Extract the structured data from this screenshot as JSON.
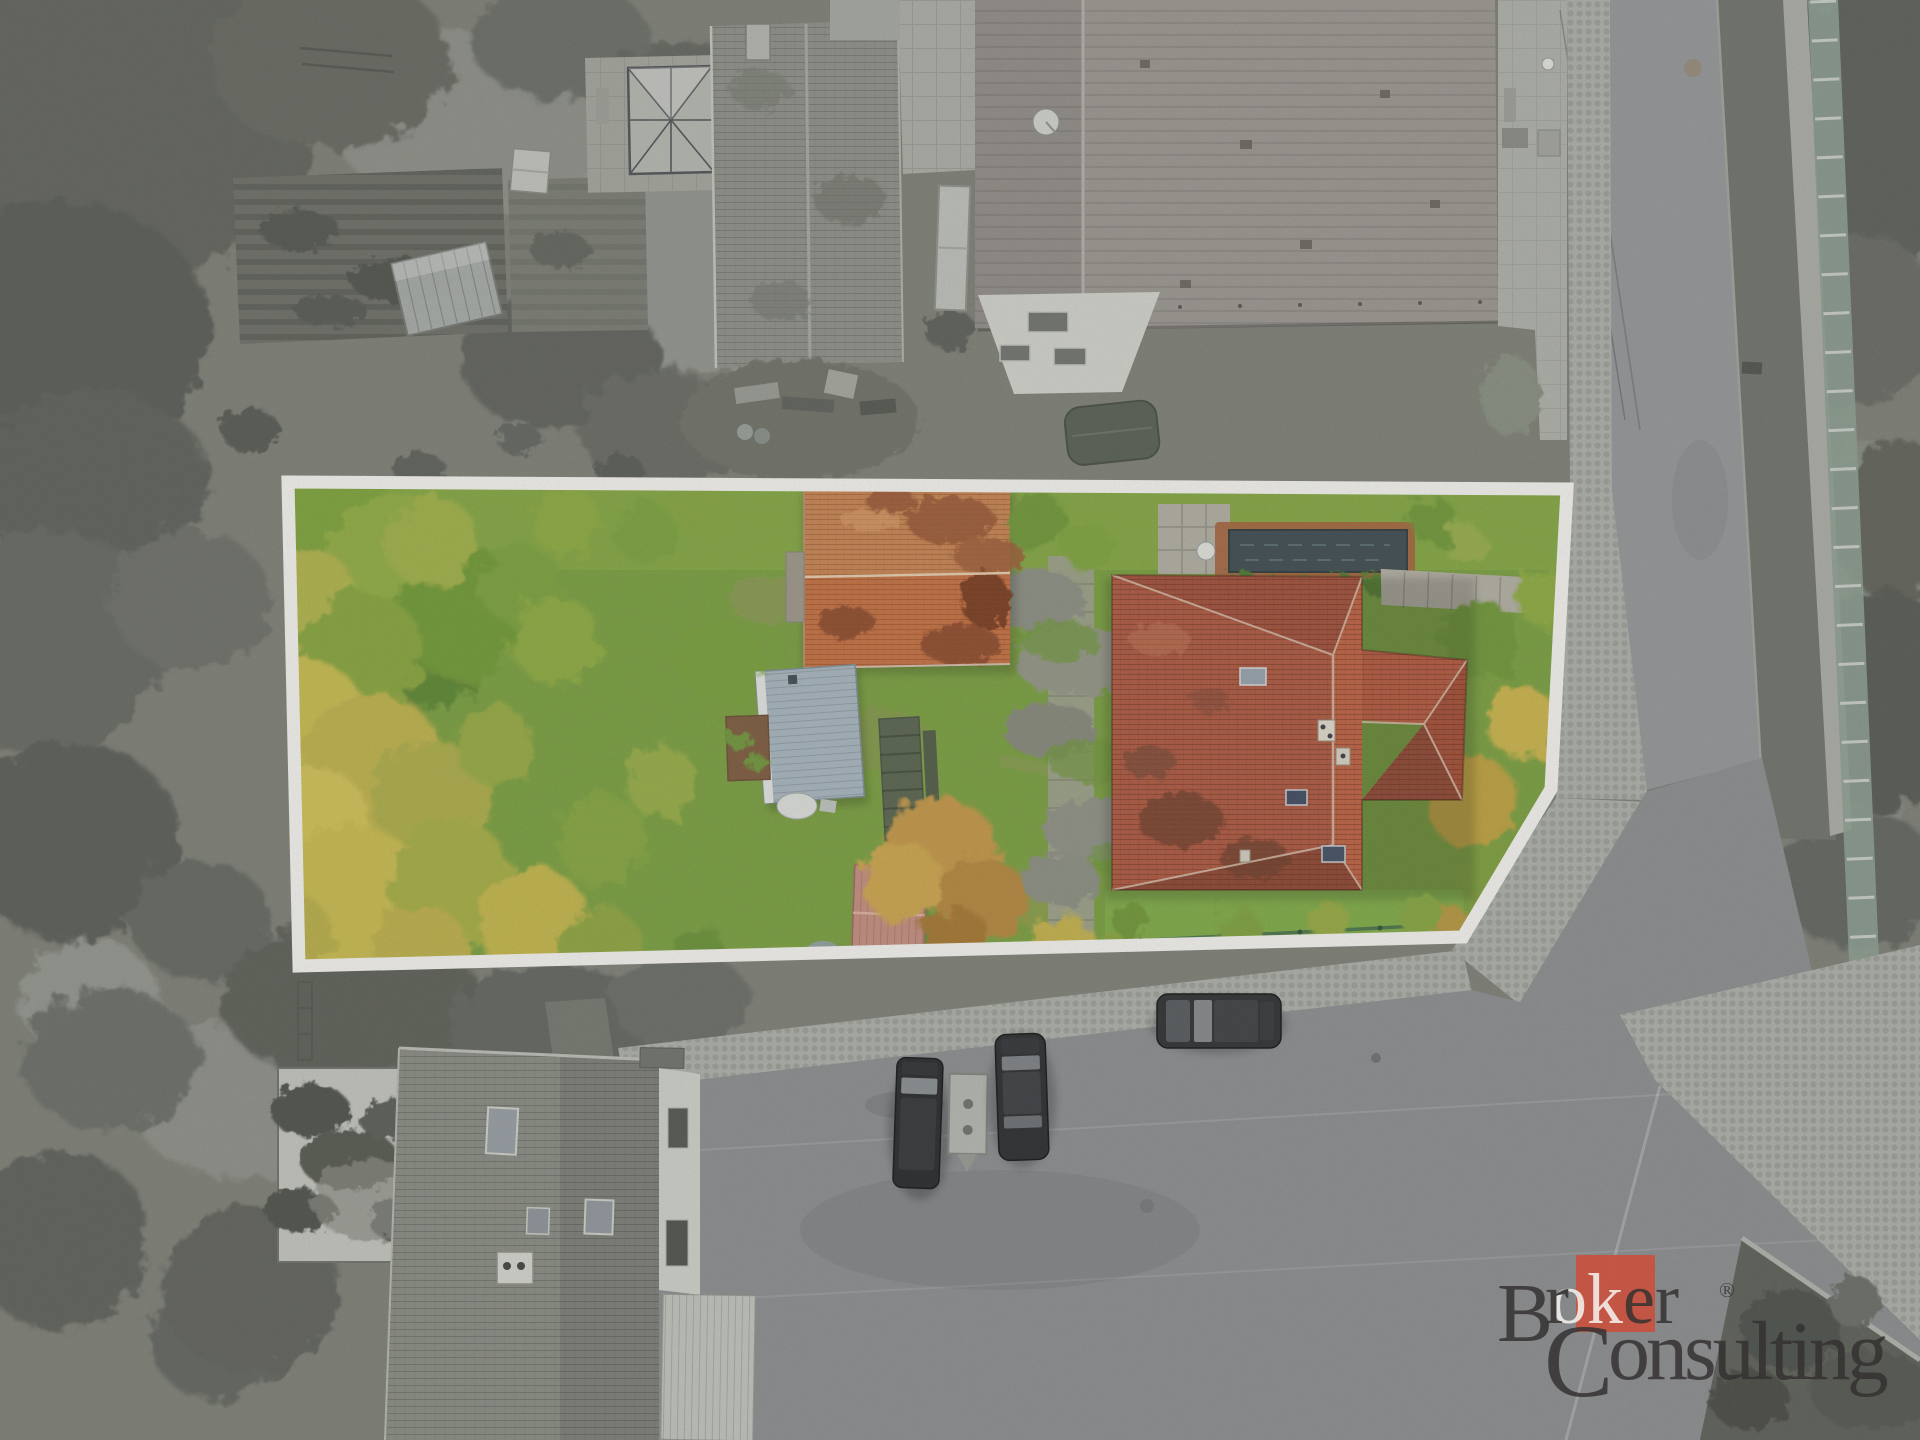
{
  "brand": {
    "line1": {
      "initial": "B",
      "pre": "r",
      "highlight": "ok",
      "post": "er"
    },
    "line2": {
      "initial": "C",
      "rest": "onsulting"
    },
    "registered_mark": "®",
    "accent_color": "#c5523f",
    "text_color": "#343231",
    "highlight_text_color": "#f7f5f1"
  },
  "scene": {
    "boundary": {
      "stroke_color": "#fcfbf6",
      "stroke_width": 13,
      "vertices": [
        [
          288,
          482
        ],
        [
          1567,
          489
        ],
        [
          1551,
          789
        ],
        [
          1463,
          937
        ],
        [
          299,
          966
        ]
      ]
    },
    "parcel": {
      "lawn_color": "#7aa23d",
      "house_roof_color": "#b0573e",
      "barn_roof_color": "#cd8550",
      "shed_roof_color": "#abbac4",
      "small_shed_roof_color": "#c98f7f",
      "pool_color": "#3c4a4f"
    },
    "surroundings": {
      "tone": "desaturated-gray",
      "road_color": "#96989b",
      "asphalt_color": "#8d8f92",
      "cobble_color": "#b1b4ad"
    }
  }
}
